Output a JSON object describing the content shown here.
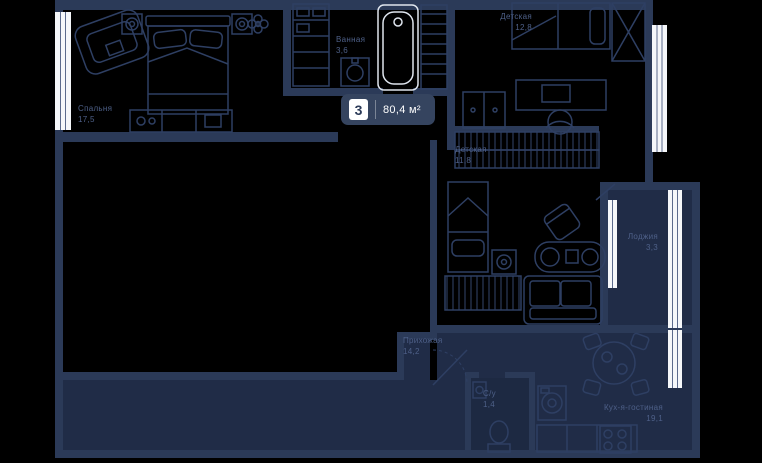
{
  "plan": {
    "badge": {
      "rooms_count": "3",
      "total_area": "80,4 м²"
    },
    "rooms": [
      {
        "id": "bedroom",
        "name": "Спальня",
        "area": "17,5"
      },
      {
        "id": "bathroom",
        "name": "Ванная",
        "area": "3,6"
      },
      {
        "id": "kids1",
        "name": "Детская",
        "area": "12,8"
      },
      {
        "id": "kids2",
        "name": "Детская",
        "area": "11,8"
      },
      {
        "id": "loggia",
        "name": "Лоджия",
        "area": "3,3"
      },
      {
        "id": "hallway",
        "name": "Прихожая",
        "area": "14,2"
      },
      {
        "id": "wc",
        "name": "С/у",
        "area": "1,4"
      },
      {
        "id": "kitchen",
        "name": "Кух-я-гостиная",
        "area": "19,1"
      }
    ],
    "colors": {
      "background": "#000000",
      "wall_fill": "#2b3a58",
      "floor_fill": "#202c47",
      "furniture_stroke": "#2e3f63",
      "window_white": "#f5f7fa",
      "label_text": "#4e6088",
      "badge_bg": "#35445f",
      "badge_text": "#ffffff"
    }
  }
}
